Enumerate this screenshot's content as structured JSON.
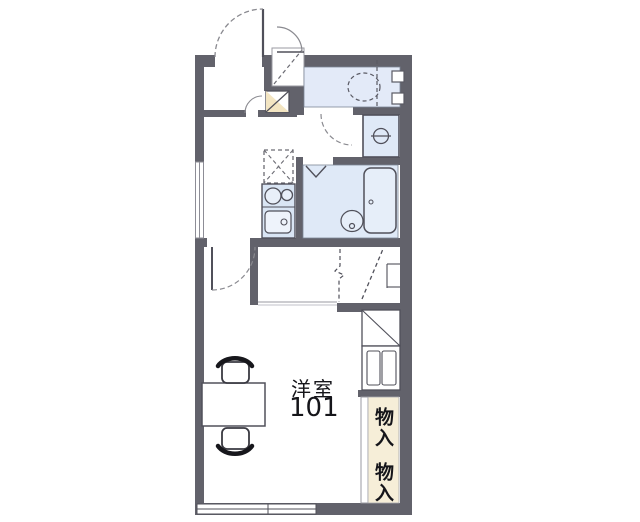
{
  "document": {
    "kind": "apartment-floor-plan",
    "room": {
      "name": "洋室",
      "number": "101"
    },
    "storage_labels": [
      "物入",
      "物入"
    ]
  },
  "features": [
    "entrance-door-swing",
    "shoe-niche",
    "water-heater-box",
    "toilet",
    "washing-machine-space",
    "bathtub",
    "washbasin",
    "bath-folding-door",
    "refrigerator-space",
    "two-burner-stove",
    "kitchen-sink",
    "room-door-swing",
    "loft-ladder",
    "closet-partition",
    "shelf-box",
    "storage-closet",
    "table",
    "chairs",
    "sliding-window",
    "kitchen-window"
  ],
  "colors": {
    "wall": "#62626b",
    "room_fill": "#e3eaf8",
    "fixture_fill": "#dde8f6",
    "storage_fill": "#f6eed8",
    "heater_fill": "#f3e5c2",
    "line": "#50505a",
    "arc": "#8a8a90",
    "text": "#15151a",
    "background": "#ffffff"
  }
}
